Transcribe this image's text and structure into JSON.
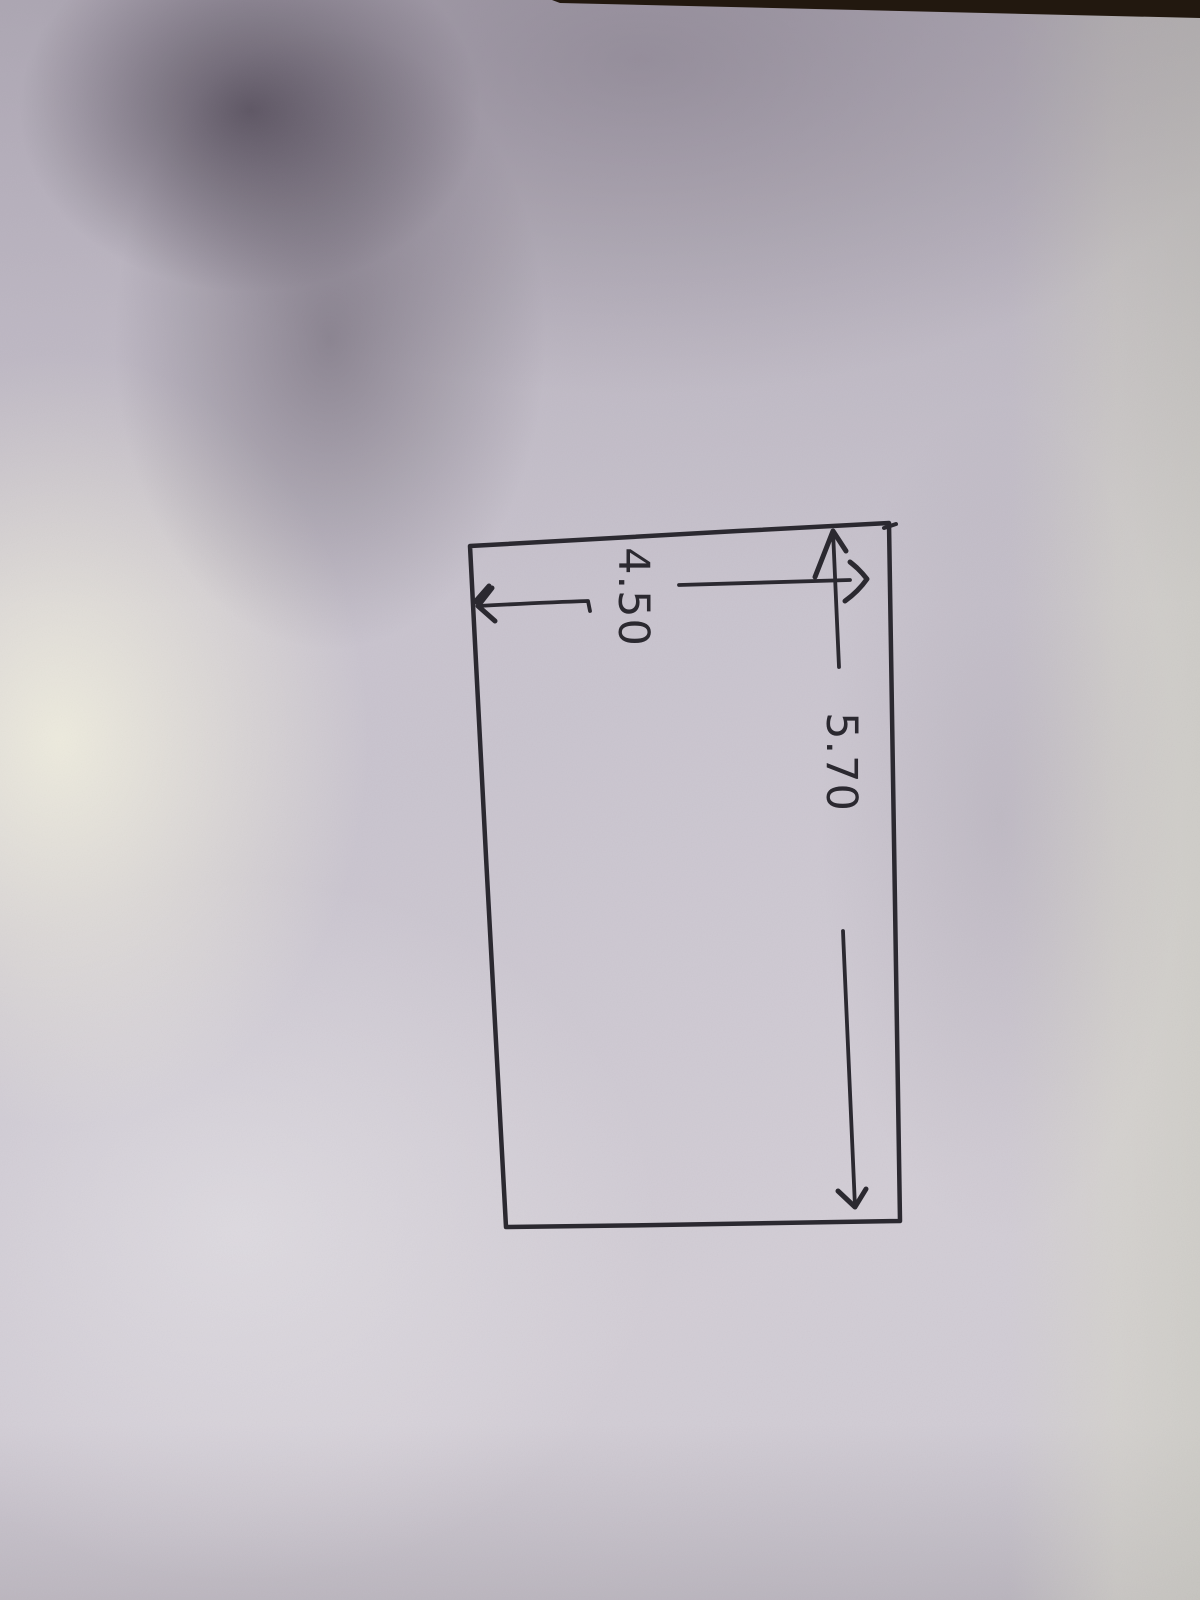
{
  "photo": {
    "description": "Photograph of a hand-drawn pen sketch on white paper; the drawing and its labels appear rotated 90 degrees in the frame, with soft camera shadows on the paper and a dark table surface sliver along the top edge",
    "paper_color": "#cbc6d0",
    "paper_highlight_color": "#ece9dc",
    "shadow_color": "#57505f",
    "table_edge_color": "#22180f",
    "ink_color": "#2b2930"
  },
  "sketch": {
    "shape": "rectangle",
    "dimension_labels": {
      "length": "5.70",
      "width": "4.50"
    }
  }
}
